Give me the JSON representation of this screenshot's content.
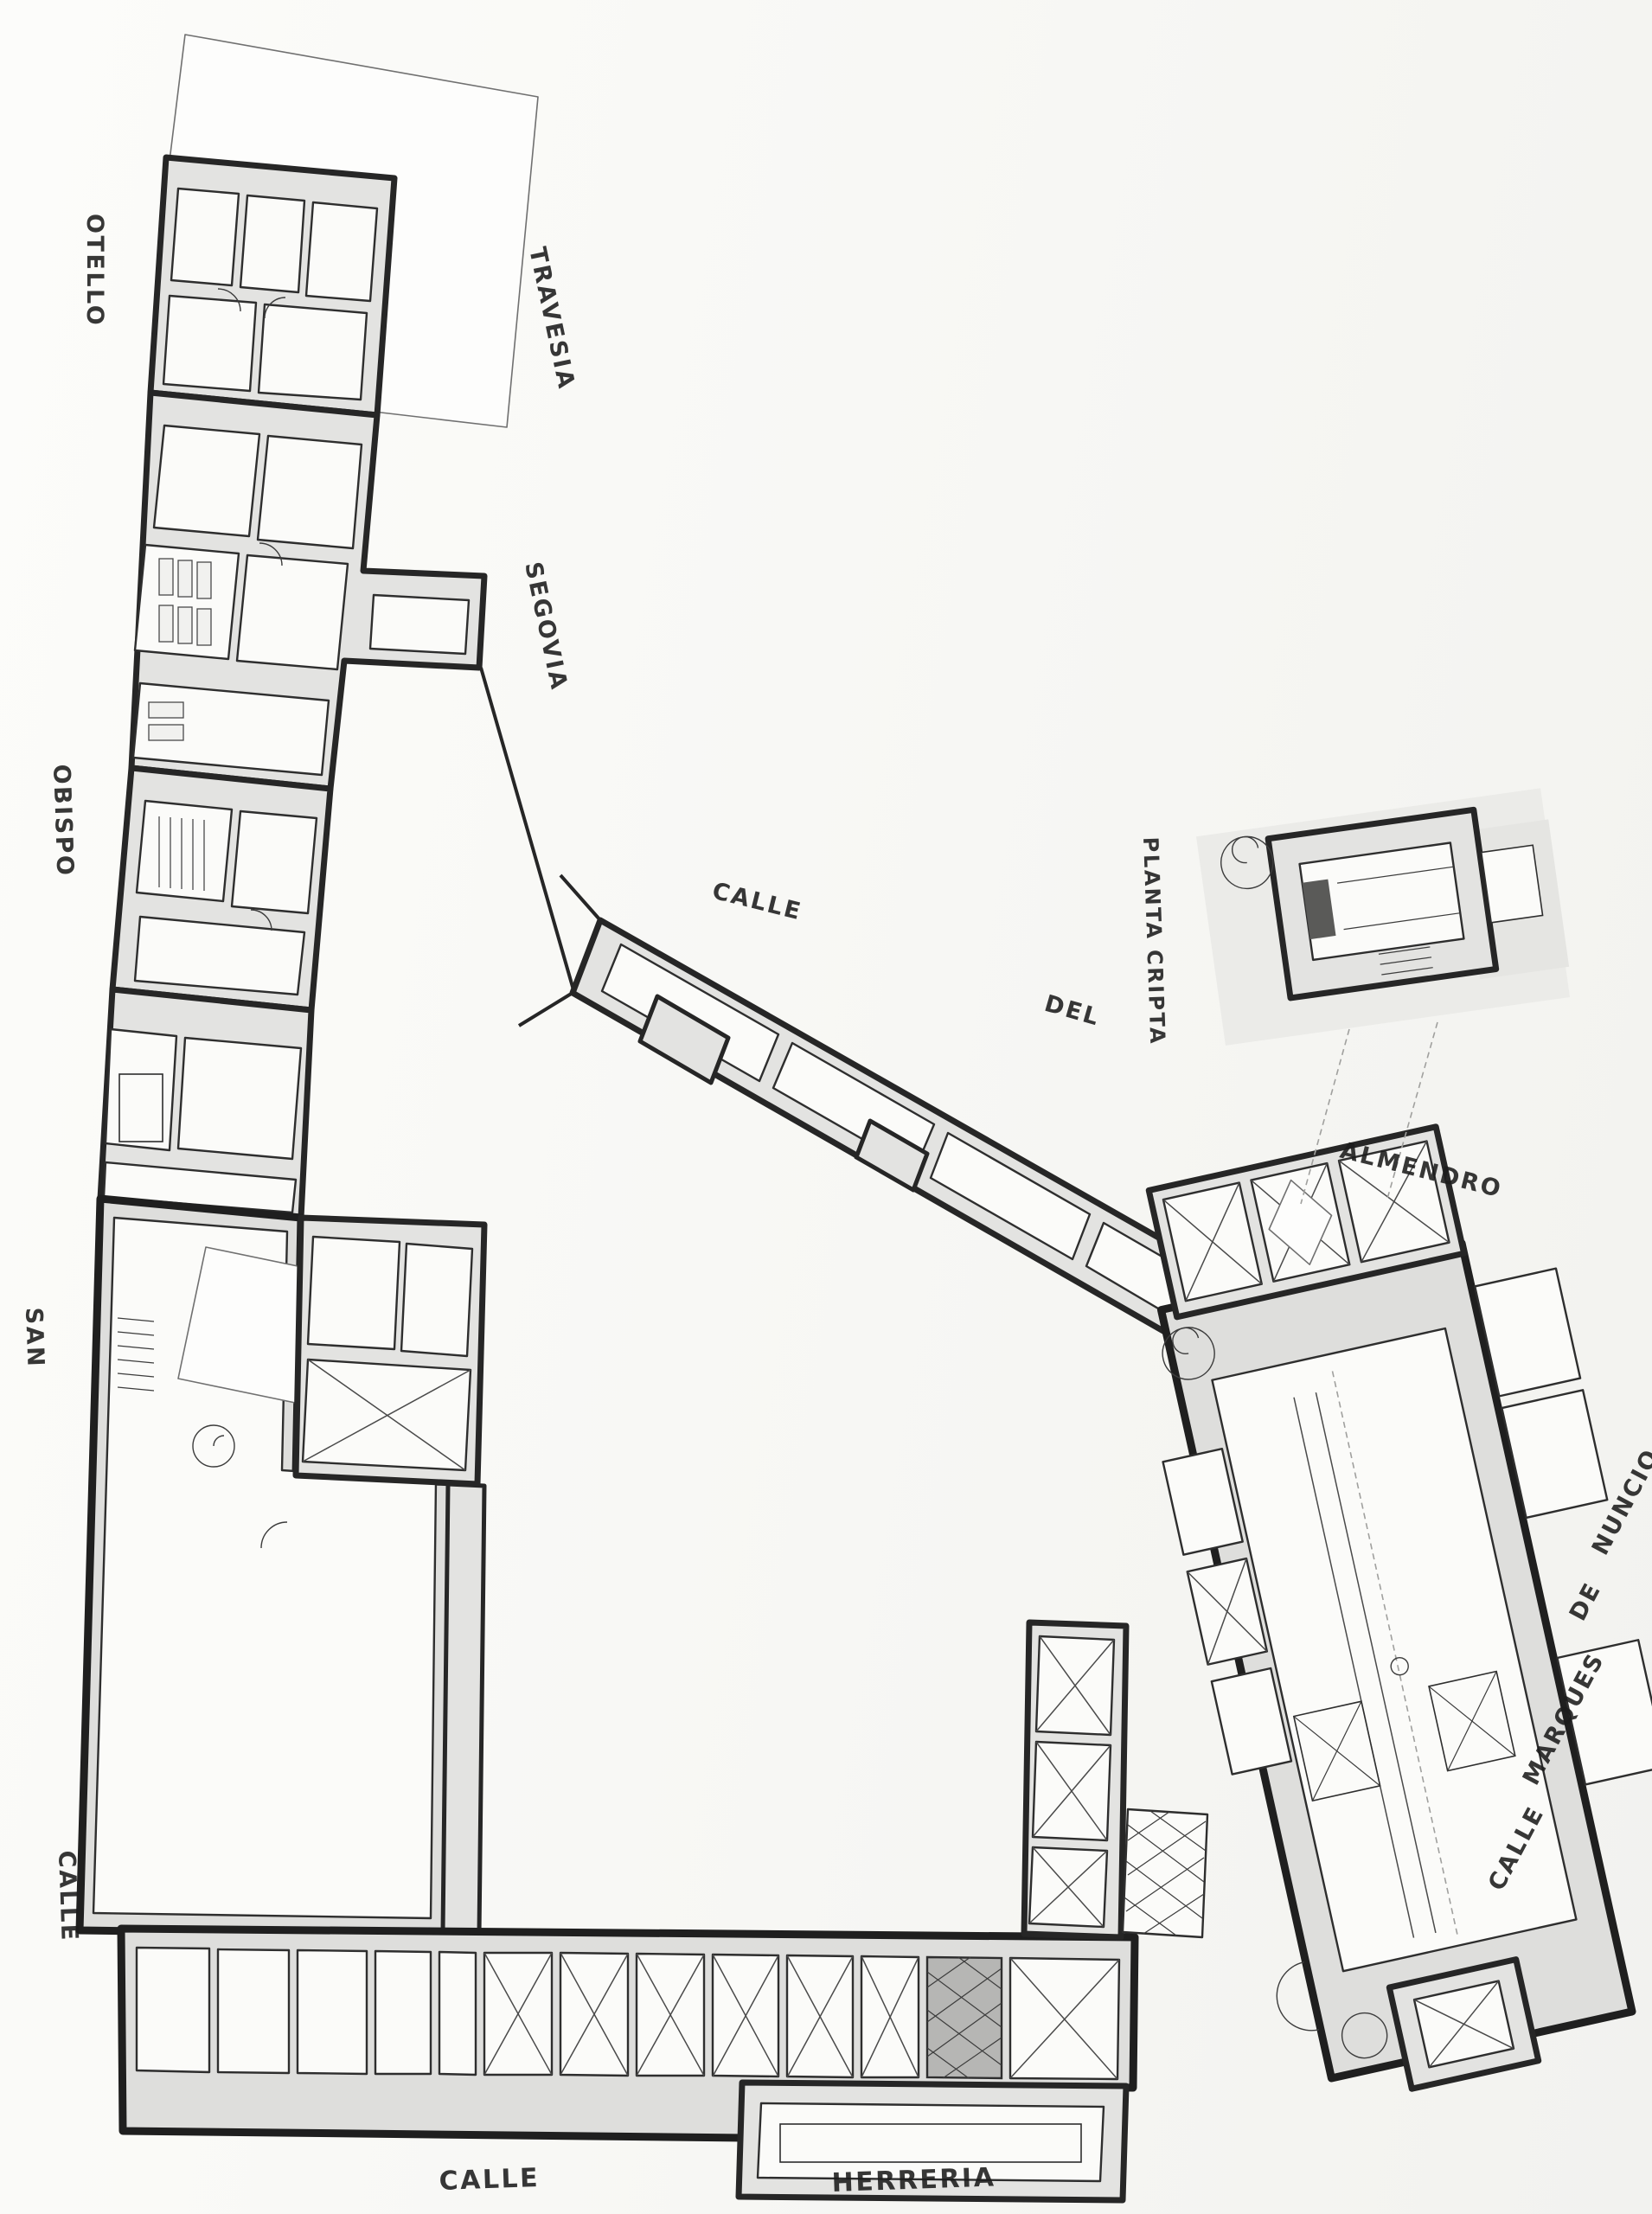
{
  "drawing": {
    "inset_title": "PLANTA CRIPTA",
    "streets": {
      "top_left_vertical": "OTELLO",
      "travesia": "TRAVESIA",
      "segovia": "SEGOVIA",
      "obispo": "OBISPO",
      "san": "SAN",
      "calle_left": "CALLE",
      "calle_mid": "CALLE",
      "del": "DEL",
      "almendro": "ALMENDRO",
      "nuncio": "NUNCIO",
      "de_right": "DE",
      "marques": "MARQUES",
      "calle_right": "CALLE",
      "calle_bottom": "CALLE",
      "herreria": "HERRERIA"
    },
    "colors": {
      "paper": "#f8f8f5",
      "wall_fill": "#e3e3e1",
      "line": "#262626",
      "label": "#1c1c1c"
    }
  }
}
